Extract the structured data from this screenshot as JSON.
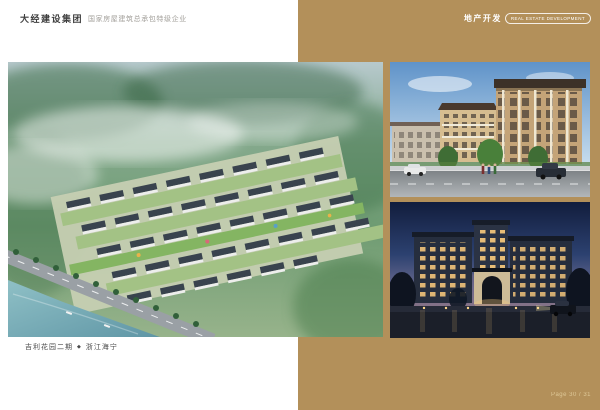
{
  "page": {
    "background": "#ffffff",
    "accent_gold": "#b3905a"
  },
  "header": {
    "company_name": "大经建设集团",
    "company_tagline": "国家房屋建筑总承包特级企业",
    "section_title_cn": "地产开发",
    "section_title_en": "REAL ESTATE DEVELOPMENT"
  },
  "caption": {
    "project_name": "吉利花园二期",
    "separator": "◆",
    "location": "浙江海宁"
  },
  "footer": {
    "page_label": "Page 30 / 31"
  }
}
